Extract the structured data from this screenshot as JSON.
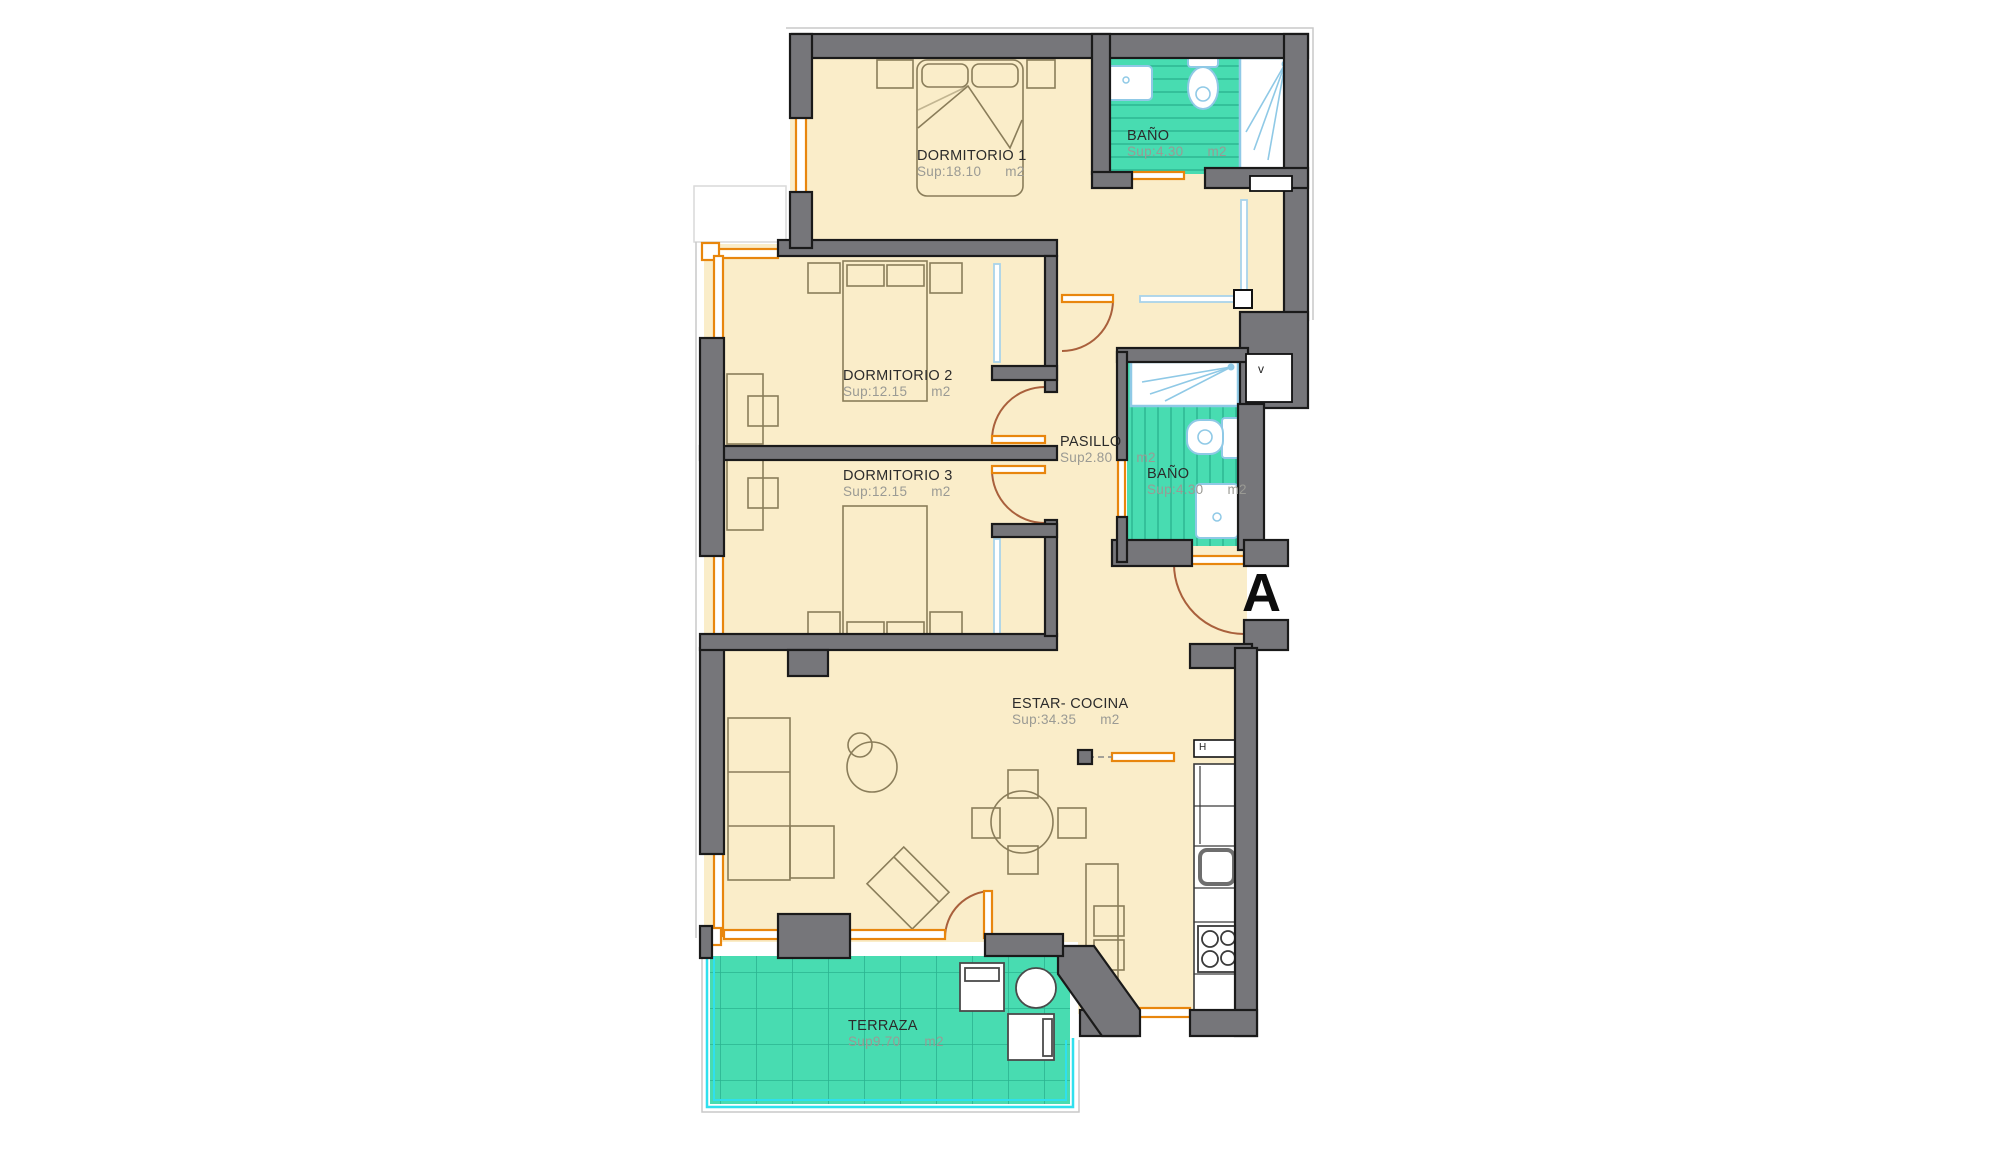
{
  "plan": {
    "title": "Apartment floor plan",
    "unit_marker": "A",
    "rooms": [
      {
        "id": "dormitorio1",
        "name": "DORMITORIO 1",
        "sup": "Sup:18.10",
        "unit": "m2"
      },
      {
        "id": "bano1",
        "name": "BAÑO",
        "sup": "Sup:4.30",
        "unit": "m2"
      },
      {
        "id": "dormitorio2",
        "name": "DORMITORIO 2",
        "sup": "Sup:12.15",
        "unit": "m2"
      },
      {
        "id": "dormitorio3",
        "name": "DORMITORIO 3",
        "sup": "Sup:12.15",
        "unit": "m2"
      },
      {
        "id": "pasillo",
        "name": "PASILLO",
        "sup": "Sup2.80",
        "unit": "m2"
      },
      {
        "id": "bano2",
        "name": "BAÑO",
        "sup": "Sup:4.30",
        "unit": "m2"
      },
      {
        "id": "estar",
        "name": "ESTAR- COCINA",
        "sup": "Sup:34.35",
        "unit": "m2"
      },
      {
        "id": "terraza",
        "name": "TERRAZA",
        "sup": "Sup9.70",
        "unit": "m2"
      }
    ],
    "shafts": {
      "vent": "v",
      "hood": "H"
    },
    "colors": {
      "floor_cream": "#FAEDC9",
      "tile_teal": "#48DCB1",
      "tile_line": "#2BB390",
      "wall_gray": "#76767A",
      "outline_black": "#1A1A1A",
      "window_orange": "#E8860D",
      "fixture_blue": "#8FC9E6",
      "door_brown": "#A9603C",
      "railing_cyan": "#2FE0EE",
      "furniture_stroke": "#8A7D5A"
    }
  }
}
